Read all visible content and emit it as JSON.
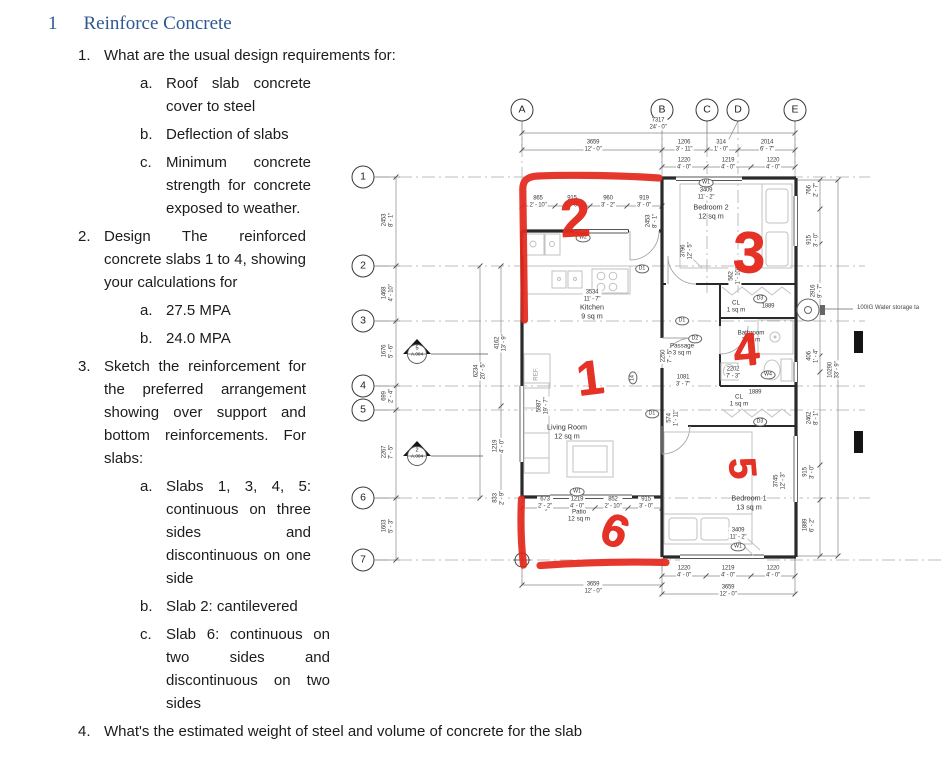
{
  "document": {
    "heading": {
      "number": "1",
      "title": "Reinforce Concrete"
    },
    "q1_number": "1.",
    "q1_text": "What are the usual design requirements for:",
    "blocks": [
      {
        "num": "a.",
        "text": "Roof slab concrete cover to steel",
        "cls": "sub"
      },
      {
        "num": "b.",
        "text": "Deflection of slabs",
        "cls": "sub"
      },
      {
        "num": "c.",
        "text": "Minimum concrete strength for concrete exposed to weather.",
        "cls": "sub"
      },
      {
        "num": "2.",
        "text": "Design The reinforced concrete slabs 1 to 4, showing your calculations for",
        "cls": "qgap"
      },
      {
        "num": "a.",
        "text": "27.5 MPA",
        "cls": "sub"
      },
      {
        "num": "b.",
        "text": "24.0 MPA",
        "cls": "sub"
      },
      {
        "num": "3.",
        "text": "Sketch the reinforcement for the preferred arrangement showing over support and bottom reinforcements. For slabs:",
        "cls": "qgap"
      },
      {
        "num": "a.",
        "text": "Slabs 1, 3, 4, 5: continuous on three sides and discontinuous on one side",
        "cls": "sub"
      },
      {
        "num": "b.",
        "text": "Slab 2: cantilevered",
        "cls": "sub"
      },
      {
        "num": "c.",
        "text": "Slab 6: continuous on two sides and discontinuous on two sides",
        "cls": "sub wide"
      },
      {
        "num": "4.",
        "text": "What's the estimated weight of steel and volume of concrete for the slab",
        "cls": "qgap wide"
      }
    ]
  },
  "plan": {
    "grid_top": [
      {
        "x": 192,
        "y": 22,
        "t": "A"
      },
      {
        "x": 332,
        "y": 22,
        "t": "B"
      },
      {
        "x": 377,
        "y": 22,
        "t": "C"
      },
      {
        "x": 408,
        "y": 22,
        "t": "D"
      },
      {
        "x": 465,
        "y": 22,
        "t": "E"
      }
    ],
    "grid_left": [
      {
        "x": 33,
        "y": 89,
        "t": "1"
      },
      {
        "x": 33,
        "y": 178,
        "t": "2"
      },
      {
        "x": 33,
        "y": 233,
        "t": "3"
      },
      {
        "x": 33,
        "y": 298,
        "t": "4"
      },
      {
        "x": 33,
        "y": 322,
        "t": "5"
      },
      {
        "x": 33,
        "y": 410,
        "t": "6"
      },
      {
        "x": 33,
        "y": 472,
        "t": "7"
      }
    ],
    "rooms": [
      {
        "x": 262,
        "y": 224,
        "t": "Kitchen\n9 sq m"
      },
      {
        "x": 237,
        "y": 344,
        "t": "Living Room\n12 sq m"
      },
      {
        "x": 381,
        "y": 124,
        "t": "Bedroom 2\n12 sq m"
      },
      {
        "x": 419,
        "y": 415,
        "t": "Bedroom 1\n13 sq m"
      },
      {
        "x": 352,
        "y": 262,
        "t": "Passage\n3 sq m",
        "c": "sm"
      },
      {
        "x": 421,
        "y": 249,
        "t": "Bathroom\n3 sq m",
        "c": "sm"
      },
      {
        "x": 406,
        "y": 219,
        "t": "CL\n1 sq m",
        "c": "sm"
      },
      {
        "x": 409,
        "y": 313,
        "t": "CL\n1 sq m",
        "c": "sm"
      },
      {
        "x": 249,
        "y": 428,
        "t": "Patio\n12 sq m",
        "c": "sm"
      },
      {
        "x": 206,
        "y": 286,
        "t": "REF.",
        "c": "rot sm"
      }
    ],
    "dims": [
      {
        "x": 328,
        "y": 36,
        "t": "7317\n24' - 0\""
      },
      {
        "x": 263,
        "y": 58,
        "t": "3659\n12' - 0\""
      },
      {
        "x": 354,
        "y": 58,
        "t": "1206\n3' - 11\""
      },
      {
        "x": 391,
        "y": 58,
        "t": "314\n1' - 0\""
      },
      {
        "x": 437,
        "y": 58,
        "t": "2014\n6' - 7\""
      },
      {
        "x": 354,
        "y": 76,
        "t": "1220\n4' - 0\""
      },
      {
        "x": 398,
        "y": 76,
        "t": "1219\n4' - 0\""
      },
      {
        "x": 443,
        "y": 76,
        "t": "1220\n4' - 0\""
      },
      {
        "x": 208,
        "y": 114,
        "t": "865\n2' - 10\""
      },
      {
        "x": 242,
        "y": 114,
        "t": "915\n3' - 0\""
      },
      {
        "x": 278,
        "y": 114,
        "t": "960\n3' - 2\""
      },
      {
        "x": 314,
        "y": 114,
        "t": "919\n3' - 0\""
      },
      {
        "x": 322,
        "y": 133,
        "t": "2453\n8' - 1\"",
        "c": "rot"
      },
      {
        "x": 58,
        "y": 132,
        "t": "2453\n8' - 1\"",
        "c": "rot"
      },
      {
        "x": 58,
        "y": 205,
        "t": "1468\n4' - 10\"",
        "c": "rot"
      },
      {
        "x": 58,
        "y": 263,
        "t": "1676\n5' - 6\"",
        "c": "rot"
      },
      {
        "x": 58,
        "y": 308,
        "t": "699\n2' - 4\"",
        "c": "rot"
      },
      {
        "x": 58,
        "y": 364,
        "t": "2267\n7' - 5\"",
        "c": "rot"
      },
      {
        "x": 58,
        "y": 438,
        "t": "1603\n5' - 3\"",
        "c": "rot"
      },
      {
        "x": 150,
        "y": 283,
        "t": "6234\n20' - 5\"",
        "c": "rot"
      },
      {
        "x": 171,
        "y": 255,
        "t": "4162\n13' - 9\"",
        "c": "rot"
      },
      {
        "x": 169,
        "y": 358,
        "t": "1219\n4' - 0\"",
        "c": "rot"
      },
      {
        "x": 169,
        "y": 410,
        "t": "833\n2' - 9\"",
        "c": "rot"
      },
      {
        "x": 213,
        "y": 318,
        "t": "5987\n19' - 7\"",
        "c": "rot"
      },
      {
        "x": 483,
        "y": 102,
        "t": "766\n2' - 7\"",
        "c": "rot"
      },
      {
        "x": 483,
        "y": 152,
        "t": "915\n3' - 0\"",
        "c": "rot"
      },
      {
        "x": 487,
        "y": 203,
        "t": "2916\n9' - 7\"",
        "c": "rot"
      },
      {
        "x": 483,
        "y": 268,
        "t": "406\n1' - 4\"",
        "c": "rot"
      },
      {
        "x": 504,
        "y": 282,
        "t": "10290\n33' - 9\"",
        "c": "rot"
      },
      {
        "x": 483,
        "y": 330,
        "t": "2462\n8' - 1\"",
        "c": "rot"
      },
      {
        "x": 479,
        "y": 384,
        "t": "915\n3' - 0\"",
        "c": "rot"
      },
      {
        "x": 479,
        "y": 437,
        "t": "1889\n6' - 2\"",
        "c": "rot"
      },
      {
        "x": 262,
        "y": 208,
        "t": "3534\n11' - 7\""
      },
      {
        "x": 376,
        "y": 106,
        "t": "3409\n11' - 2\""
      },
      {
        "x": 408,
        "y": 446,
        "t": "3409\n11' - 2\""
      },
      {
        "x": 357,
        "y": 163,
        "t": "3796\n12' - 5\"",
        "c": "rot"
      },
      {
        "x": 450,
        "y": 393,
        "t": "3745\n12' - 3\"",
        "c": "rot"
      },
      {
        "x": 337,
        "y": 268,
        "t": "2250\n7' - 5\"",
        "c": "rot"
      },
      {
        "x": 343,
        "y": 330,
        "t": "574\n1' - 11\"",
        "c": "rot"
      },
      {
        "x": 405,
        "y": 188,
        "t": "562\n1' - 10\"",
        "c": "rot"
      },
      {
        "x": 403,
        "y": 285,
        "t": "2202\n7' - 3\""
      },
      {
        "x": 353,
        "y": 293,
        "t": "1081\n3' - 7\""
      },
      {
        "x": 438,
        "y": 219,
        "t": "1889"
      },
      {
        "x": 425,
        "y": 305,
        "t": "1889"
      },
      {
        "x": 215,
        "y": 415,
        "t": "673\n2' - 2\""
      },
      {
        "x": 247,
        "y": 415,
        "t": "1219\n4' - 0\""
      },
      {
        "x": 283,
        "y": 415,
        "t": "852\n2' - 10\""
      },
      {
        "x": 316,
        "y": 415,
        "t": "915\n3' - 0\""
      },
      {
        "x": 263,
        "y": 500,
        "t": "3659\n12' - 0\""
      },
      {
        "x": 354,
        "y": 484,
        "t": "1220\n4' - 0\""
      },
      {
        "x": 398,
        "y": 484,
        "t": "1219\n4' - 0\""
      },
      {
        "x": 443,
        "y": 484,
        "t": "1220\n4' - 0\""
      },
      {
        "x": 398,
        "y": 503,
        "t": "3659\n12' - 0\""
      }
    ],
    "tags": [
      {
        "x": 376,
        "y": 95,
        "t": "W1"
      },
      {
        "x": 253,
        "y": 150,
        "t": "W2"
      },
      {
        "x": 312,
        "y": 181,
        "t": "D1"
      },
      {
        "x": 352,
        "y": 233,
        "t": "D1"
      },
      {
        "x": 365,
        "y": 251,
        "t": "D2"
      },
      {
        "x": 322,
        "y": 326,
        "t": "D1"
      },
      {
        "x": 430,
        "y": 211,
        "t": "D3"
      },
      {
        "x": 430,
        "y": 334,
        "t": "D3"
      },
      {
        "x": 247,
        "y": 404,
        "t": "W1"
      },
      {
        "x": 408,
        "y": 459,
        "t": "W1"
      },
      {
        "x": 438,
        "y": 287,
        "t": "W4"
      },
      {
        "x": 303,
        "y": 290,
        "t": "14",
        "c": "rot"
      }
    ],
    "sections": [
      {
        "x": 87,
        "y": 263,
        "n": "5",
        "f": "A.004"
      },
      {
        "x": 87,
        "y": 365,
        "n": "2",
        "f": "A.004"
      }
    ],
    "red_marks": [
      {
        "x": 245,
        "y": 130,
        "t": "2",
        "s": 54,
        "r": -3
      },
      {
        "x": 260,
        "y": 291,
        "t": "1",
        "s": 48,
        "r": -7
      },
      {
        "x": 419,
        "y": 165,
        "t": "3",
        "s": 58,
        "r": 2
      },
      {
        "x": 416,
        "y": 261,
        "t": "4",
        "s": 46,
        "r": -5
      },
      {
        "x": 412,
        "y": 380,
        "t": "5",
        "s": 38,
        "r": 85
      },
      {
        "x": 285,
        "y": 442,
        "t": "6",
        "s": 46,
        "r": 22
      }
    ],
    "callout": {
      "text": "100IG Water storage ta"
    }
  }
}
